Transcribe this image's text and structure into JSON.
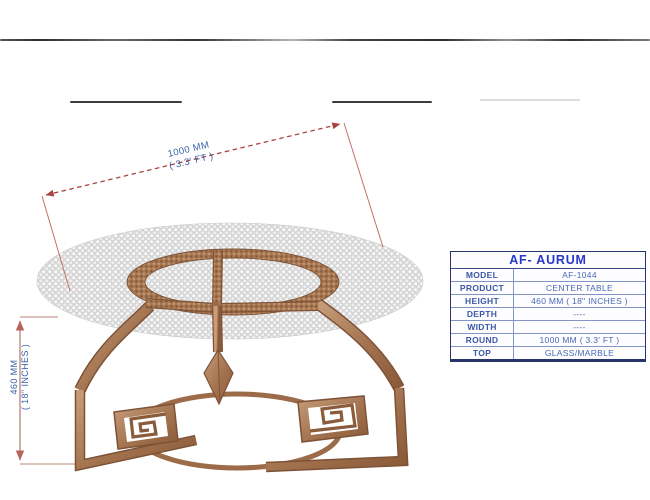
{
  "drawing": {
    "diameter_dim": {
      "line1": "1000 MM",
      "line2": "( 3.3' FT )"
    },
    "height_dim": {
      "line1": "460 MM",
      "line2": "( 18\" INCHES )"
    }
  },
  "spec_table": {
    "title": "AF- AURUM",
    "rows": [
      {
        "label": "MODEL",
        "value": "AF-1044"
      },
      {
        "label": "PRODUCT",
        "value": "CENTER TABLE"
      },
      {
        "label": "HEIGHT",
        "value": "460 MM ( 18\" INCHES )"
      },
      {
        "label": "DEPTH",
        "value": "----"
      },
      {
        "label": "WIDTH",
        "value": "----"
      },
      {
        "label": "ROUND",
        "value": "1000 MM ( 3.3' FT )"
      },
      {
        "label": "TOP",
        "value": "GLASS/MARBLE"
      }
    ]
  },
  "colors": {
    "bronze": "#ab7b58",
    "bronze_dark": "#7d5236",
    "glass_grey": "#d9d9d9",
    "dimension_red": "#a84440",
    "dimension_soft": "#c59b93",
    "dim_text_blue": "#3a5fa6",
    "table_header_blue": "#2737c9",
    "table_inner_border": "#8295c5",
    "table_outer_border": "#27356b"
  }
}
